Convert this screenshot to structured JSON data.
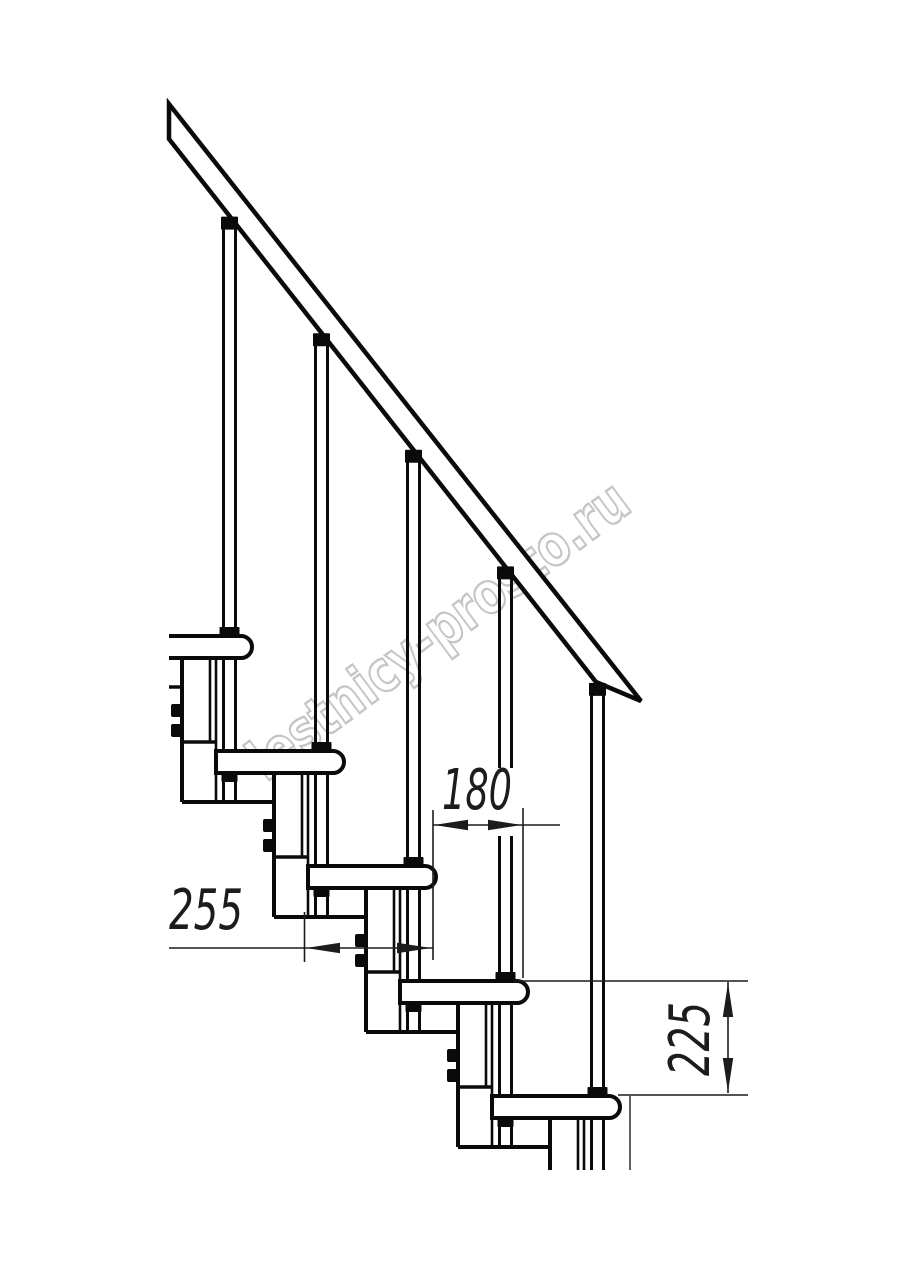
{
  "document": {
    "type": "technical-drawing",
    "subject": "modular staircase side elevation"
  },
  "canvas": {
    "width": 914,
    "height": 1280,
    "background": "#ffffff",
    "ink": "#0a0a0a",
    "dim_ink": "#1c1c1c"
  },
  "watermark": {
    "text": "lestnicy-prosto.ru",
    "color": "#ababab",
    "opacity": 0.68
  },
  "dimensions": [
    {
      "id": "tread-depth",
      "label": "255",
      "orientation": "horizontal"
    },
    {
      "id": "step-run",
      "label": "180",
      "orientation": "horizontal"
    },
    {
      "id": "step-rise",
      "label": "225",
      "orientation": "vertical"
    }
  ],
  "structure": {
    "treads_visible": 5,
    "balusters_visible": 5,
    "support_modules_visible": 5,
    "handrail": true
  }
}
